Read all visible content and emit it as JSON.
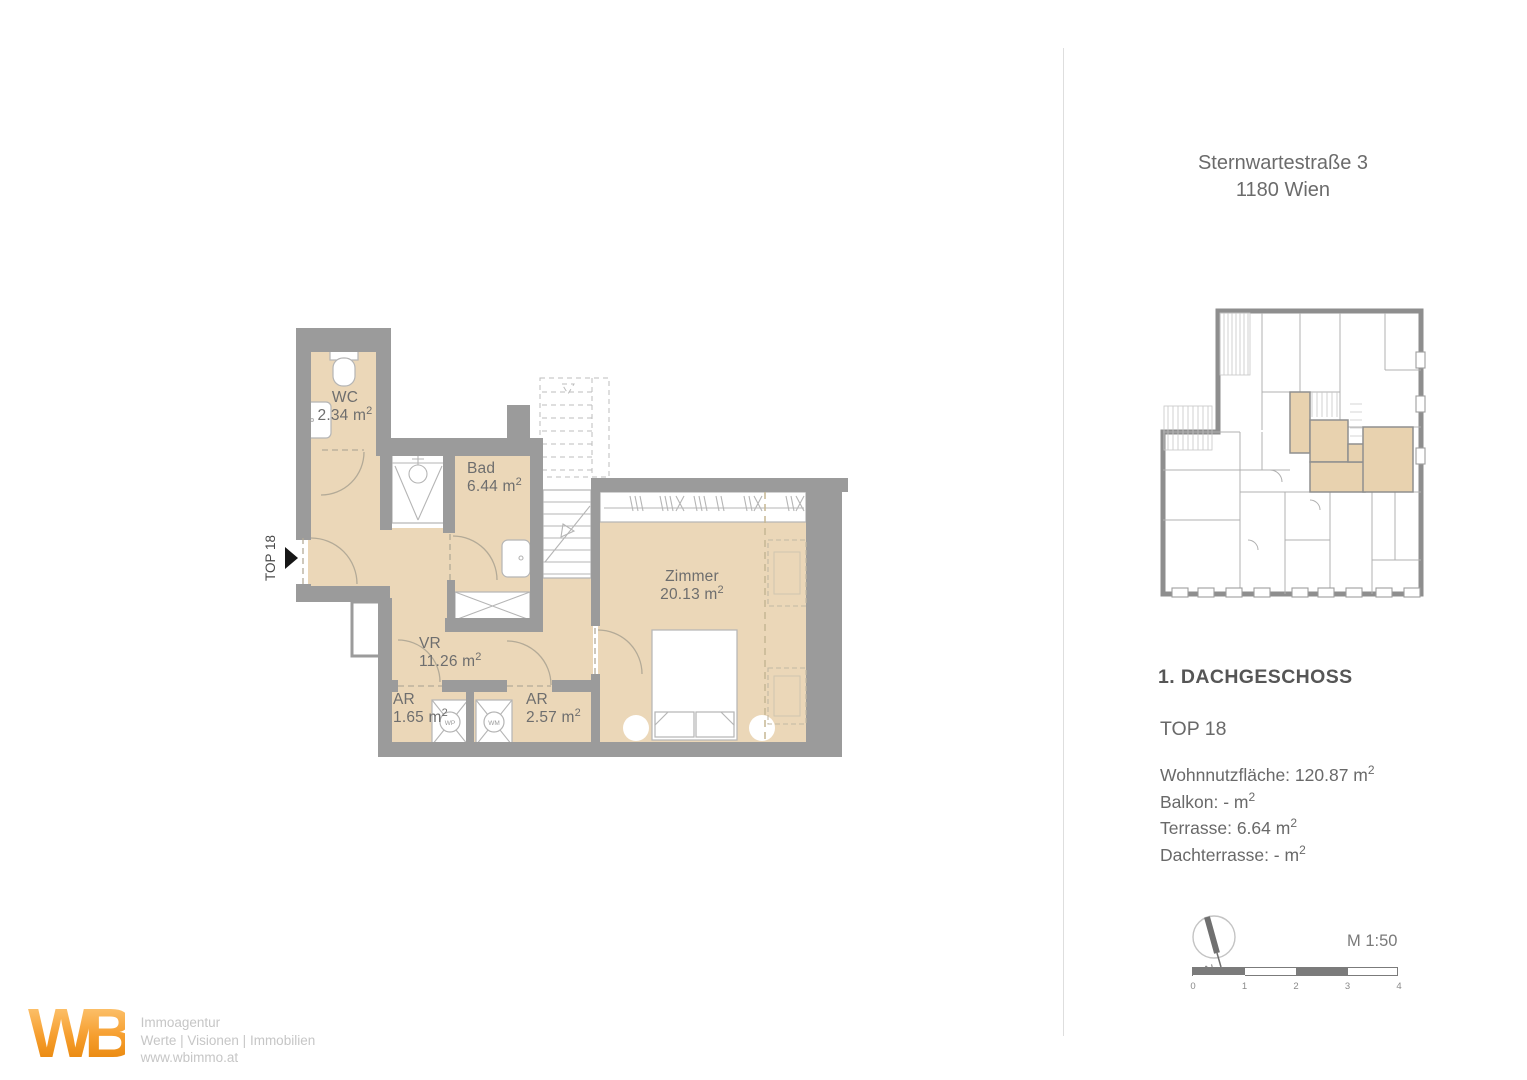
{
  "header": {
    "address_line1": "Sternwartestraße 3",
    "address_line2": "1180 Wien"
  },
  "info": {
    "floor_label": "1. DACHGESCHOSS",
    "unit_label": "TOP 18",
    "stats": [
      {
        "text": "Wohnnutzfläche: 120.87 m",
        "sup": "2"
      },
      {
        "text": "Balkon: - m",
        "sup": "2"
      },
      {
        "text": "Terrasse: 6.64 m",
        "sup": "2"
      },
      {
        "text": "Dachterrasse: - m",
        "sup": "2"
      }
    ]
  },
  "plan": {
    "unit_marker": "TOP 18",
    "rooms": [
      {
        "name": "WC",
        "area": "2.34 m",
        "sup": "2"
      },
      {
        "name": "Bad",
        "area": "6.44 m",
        "sup": "2"
      },
      {
        "name": "Zimmer",
        "area": "20.13 m",
        "sup": "2"
      },
      {
        "name": "VR",
        "area": "11.26 m",
        "sup": "2"
      },
      {
        "name": "AR",
        "area": "1.65 m",
        "sup": "2"
      },
      {
        "name": "AR",
        "area": "2.57 m",
        "sup": "2"
      }
    ],
    "appliances": [
      "WP",
      "WM"
    ]
  },
  "scale": {
    "map_scale": "M 1:50",
    "north": "N",
    "ticks": [
      "0",
      "1",
      "2",
      "3",
      "4"
    ]
  },
  "logo": {
    "monogram": "WB",
    "line1": "Immoagentur",
    "line2": "Werte | Visionen | Immobilien",
    "line3": "www.wbimmo.at"
  },
  "colors": {
    "floor": "#ebd7b8",
    "wall": "#9b9b9b",
    "accent_orange": "#f59b2d",
    "mini_highlight": "#e8d2af"
  }
}
